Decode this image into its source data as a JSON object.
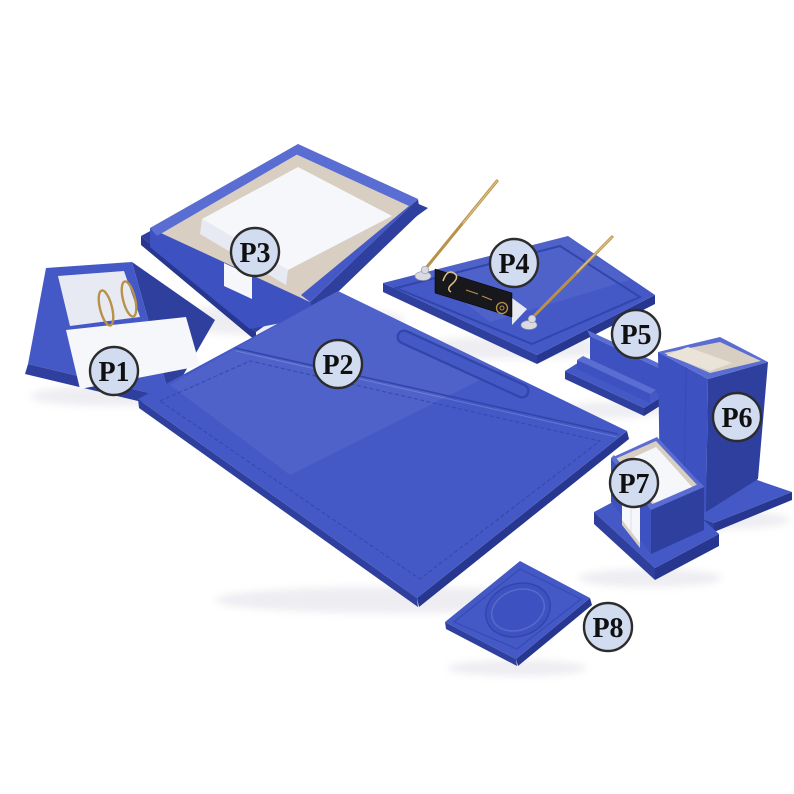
{
  "photo": {
    "background": "#ffffff",
    "subject": "blue leather desk organizer set, eight pieces, numbered part labels"
  },
  "colors": {
    "background": "#ffffff",
    "blue_top": "#4459c6",
    "blue_top_light": "#5a6dd2",
    "blue_mid": "#3d52c0",
    "blue_side": "#2e3f9d",
    "blue_side_dark": "#273790",
    "blue_line": "#3146ac",
    "blue_deep": "#1f2d77",
    "cream": "#d8cec1",
    "cream_light": "#eae3d7",
    "paper": "#f6f7fb",
    "paper_shade": "#e8eaf3",
    "gold": "#b8924a",
    "gold_light": "#ddc084",
    "gold_dark": "#8a682c",
    "silver": "#d9dae2",
    "nameplate_black": "#17171c",
    "label_fill": "#d2dcf1",
    "label_border": "#2c2c2c",
    "label_text": "#101010"
  },
  "product_labels": [
    {
      "id": "P1",
      "text": "P1",
      "item": "ring-memo-pad-holder"
    },
    {
      "id": "P2",
      "text": "P2",
      "item": "desk-pad-blotter"
    },
    {
      "id": "P3",
      "text": "P3",
      "item": "document-tray"
    },
    {
      "id": "P4",
      "text": "P4",
      "item": "double-pen-stand"
    },
    {
      "id": "P5",
      "text": "P5",
      "item": "business-card-holder"
    },
    {
      "id": "P6",
      "text": "P6",
      "item": "pencil-cup"
    },
    {
      "id": "P7",
      "text": "P7",
      "item": "memo-cube-holder"
    },
    {
      "id": "P8",
      "text": "P8",
      "item": "coaster"
    }
  ]
}
